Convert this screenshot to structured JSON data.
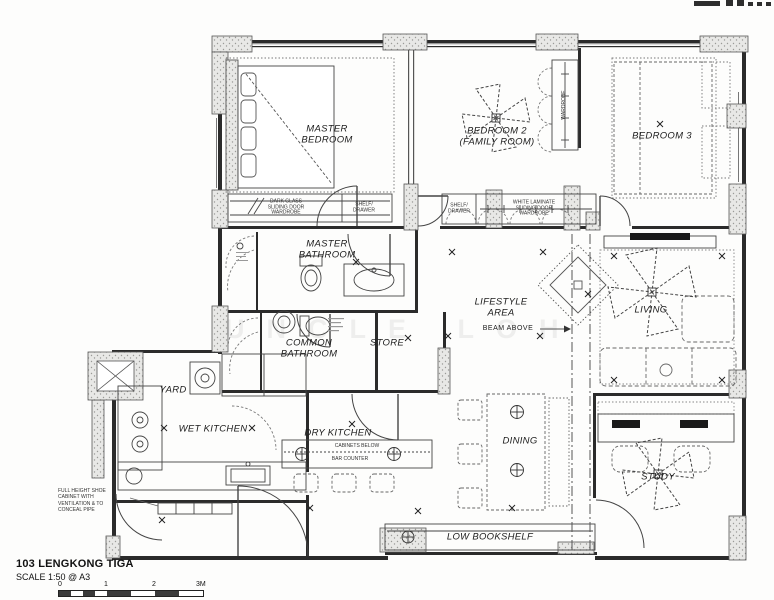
{
  "title_block": {
    "project_name": "103 LENGKONG TIGA",
    "scale_note": "SCALE 1:50 @ A3",
    "scale_ticks": [
      "0",
      "1",
      "2",
      "3M"
    ]
  },
  "watermark": "UNCLE LOH",
  "room_labels": {
    "master_bedroom": "MASTER\nBEDROOM",
    "bedroom2": "BEDROOM 2\n(FAMILY ROOM)",
    "bedroom3": "BEDROOM 3",
    "master_bathroom": "MASTER\nBATHROOM",
    "common_bathroom": "COMMON\nBATHROOM",
    "store": "STORE",
    "lifestyle_area": "LIFESTYLE\nAREA",
    "living": "LIVING",
    "yard": "YARD",
    "wet_kitchen": "WET KITCHEN",
    "dry_kitchen": "DRY KITCHEN",
    "dining": "DINING",
    "study": "STUDY",
    "low_bookshelf": "LOW BOOKSHELF"
  },
  "annotations": {
    "beam_above": "BEAM ABOVE",
    "master_wardrobe": "DARK GLASS\nSLIDING DOOR\nWARDROBE",
    "master_shelf": "SHELF/\nDRAWER",
    "bedroom2_drawer": "SHELF/\nDRAWER",
    "bedroom2_wardrobe": "WHITE LAMINATE\nSLIDING DOOR\nWARDROBE",
    "bedroom2_tall_wardrobe": "WARDROBE",
    "shoe_cabinet": "FULL HEIGHT SHOE\nCABINET WITH\nVENTILATION & TO\nCONCEAL PIPE",
    "cabinets_below": "CABINETS BELOW",
    "bar_counter": "BAR COUNTER"
  },
  "icons": {
    "ceiling_fan": "four dashed pinwheel blades",
    "pendant_light": "circle with cross",
    "light_point": "small x marker",
    "cropped_logo": "dark glyph fragments cut off at top edge"
  },
  "colors": {
    "line": "#3a3a3a",
    "hatch_fill": "#e8e8e6",
    "hatch_dot": "#9a9a97",
    "paper": "#fdfdfc",
    "watermark": "rgba(70,70,70,0.08)"
  }
}
